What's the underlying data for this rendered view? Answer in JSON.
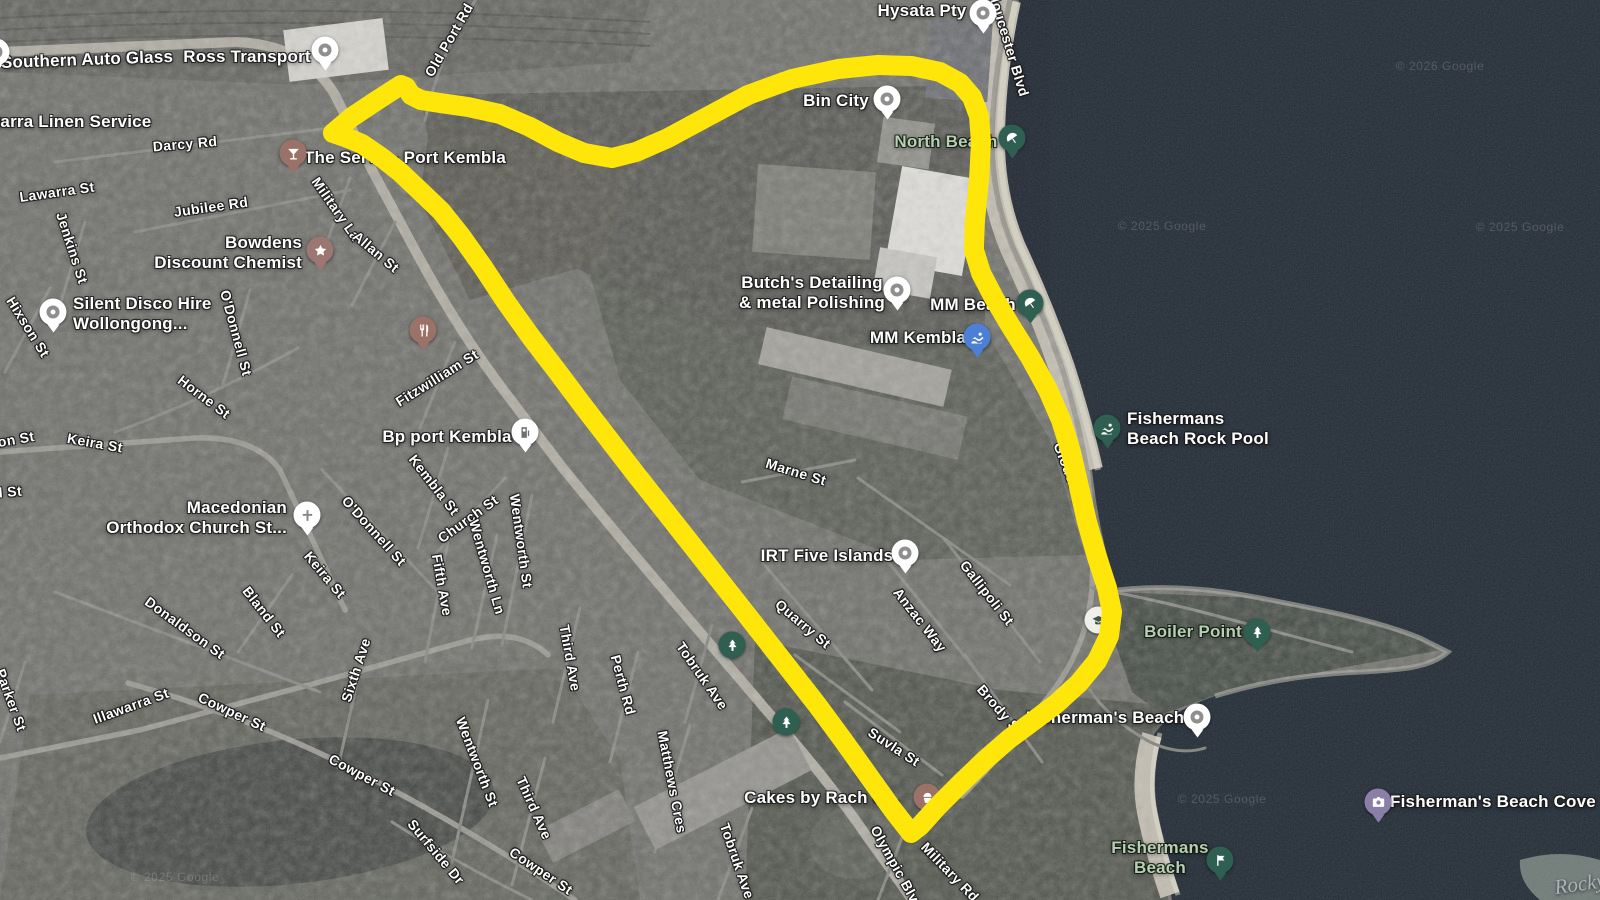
{
  "map": {
    "type": "satellite",
    "region": "Port Kembla",
    "colors": {
      "highlight": "#ffe60a",
      "water": "#1e2631",
      "land": "#696964",
      "sand": "#c2bdb0",
      "street_label": "#ffffff",
      "nature_label": "#b9cfb5"
    }
  },
  "overlay": {
    "name": "suburb-boundary-highlight",
    "color": "#ffe60a",
    "stroke_width": 20,
    "polygon_points": [
      [
        333,
        133
      ],
      [
        352,
        117
      ],
      [
        376,
        101
      ],
      [
        393,
        90
      ],
      [
        401,
        85
      ],
      [
        406,
        87
      ],
      [
        411,
        95
      ],
      [
        421,
        100
      ],
      [
        440,
        103
      ],
      [
        468,
        107
      ],
      [
        500,
        114
      ],
      [
        530,
        127
      ],
      [
        558,
        142
      ],
      [
        584,
        153
      ],
      [
        612,
        158
      ],
      [
        636,
        152
      ],
      [
        668,
        138
      ],
      [
        705,
        118
      ],
      [
        748,
        95
      ],
      [
        792,
        79
      ],
      [
        838,
        69
      ],
      [
        878,
        65
      ],
      [
        912,
        66
      ],
      [
        940,
        72
      ],
      [
        960,
        83
      ],
      [
        972,
        97
      ],
      [
        979,
        116
      ],
      [
        981,
        142
      ],
      [
        979,
        180
      ],
      [
        975,
        220
      ],
      [
        974,
        250
      ],
      [
        981,
        273
      ],
      [
        994,
        298
      ],
      [
        1010,
        325
      ],
      [
        1030,
        357
      ],
      [
        1048,
        390
      ],
      [
        1061,
        420
      ],
      [
        1071,
        452
      ],
      [
        1079,
        487
      ],
      [
        1087,
        522
      ],
      [
        1097,
        557
      ],
      [
        1107,
        588
      ],
      [
        1112,
        612
      ],
      [
        1109,
        636
      ],
      [
        1097,
        661
      ],
      [
        1079,
        683
      ],
      [
        1056,
        704
      ],
      [
        1032,
        722
      ],
      [
        1009,
        739
      ],
      [
        986,
        759
      ],
      [
        962,
        782
      ],
      [
        938,
        806
      ],
      [
        920,
        826
      ],
      [
        911,
        833
      ],
      [
        893,
        810
      ],
      [
        868,
        775
      ],
      [
        843,
        740
      ],
      [
        818,
        706
      ],
      [
        793,
        674
      ],
      [
        768,
        642
      ],
      [
        743,
        610
      ],
      [
        717,
        577
      ],
      [
        691,
        544
      ],
      [
        665,
        511
      ],
      [
        638,
        477
      ],
      [
        611,
        442
      ],
      [
        584,
        407
      ],
      [
        557,
        371
      ],
      [
        531,
        337
      ],
      [
        506,
        302
      ],
      [
        483,
        267
      ],
      [
        461,
        236
      ],
      [
        441,
        211
      ],
      [
        419,
        190
      ],
      [
        400,
        172
      ],
      [
        381,
        157
      ],
      [
        362,
        144
      ],
      [
        345,
        137
      ],
      [
        333,
        133
      ]
    ]
  },
  "labels": [
    {
      "text": "Southern Auto Glass",
      "x": 87,
      "y": 60,
      "rot": -2,
      "cls": "poi"
    },
    {
      "text": "Ross Transport",
      "x": 247,
      "y": 57,
      "rot": 0,
      "cls": "poi"
    },
    {
      "text": "Illawarra Linen Service",
      "x": 57,
      "y": 122,
      "rot": 0,
      "cls": "poi"
    },
    {
      "text": "Darcy Rd",
      "x": 185,
      "y": 144,
      "rot": -5,
      "cls": "st"
    },
    {
      "text": "Lawarra St",
      "x": 57,
      "y": 192,
      "rot": -8,
      "cls": "st"
    },
    {
      "text": "Jubilee Rd",
      "x": 211,
      "y": 207,
      "rot": -8,
      "cls": "st"
    },
    {
      "text": "Jenkins St",
      "x": 72,
      "y": 248,
      "rot": 72,
      "cls": "st"
    },
    {
      "text": "Hixson St",
      "x": 28,
      "y": 327,
      "rot": 58,
      "cls": "st"
    },
    {
      "text": "Bowdens\nDiscount Chemist",
      "x": 302,
      "y": 253,
      "rot": 0,
      "cls": "poi",
      "align": "right"
    },
    {
      "text": "Silent Disco Hire\nWollongong...",
      "x": 73,
      "y": 314,
      "rot": 0,
      "cls": "poi",
      "align": "left"
    },
    {
      "text": "Military La",
      "x": 336,
      "y": 209,
      "rot": 55,
      "cls": "st"
    },
    {
      "text": "Allan St",
      "x": 376,
      "y": 252,
      "rot": 40,
      "cls": "st"
    },
    {
      "text": "The Servo - Port Kembla",
      "x": 405,
      "y": 158,
      "rot": 0,
      "cls": "poi"
    },
    {
      "text": "Old Port Rd",
      "x": 449,
      "y": 40,
      "rot": -60,
      "cls": "st"
    },
    {
      "text": "Hysata Pty",
      "x": 922,
      "y": 11,
      "rot": 0,
      "cls": "poi"
    },
    {
      "text": "Bin City",
      "x": 836,
      "y": 101,
      "rot": 0,
      "cls": "poi"
    },
    {
      "text": "North Beach",
      "x": 946,
      "y": 142,
      "rot": 0,
      "cls": "nature"
    },
    {
      "text": "Gloucester Blvd",
      "x": 1008,
      "y": 42,
      "rot": 73,
      "cls": "st"
    },
    {
      "text": "Butch's Detailing\n& metal Polishing",
      "x": 812,
      "y": 293,
      "rot": 0,
      "cls": "poi"
    },
    {
      "text": "MM Beach",
      "x": 973,
      "y": 305,
      "rot": 0,
      "cls": "poi"
    },
    {
      "text": "MM Kembla",
      "x": 918,
      "y": 338,
      "rot": 0,
      "cls": "poi"
    },
    {
      "text": "Fishermans\nBeach Rock Pool",
      "x": 1127,
      "y": 429,
      "rot": 0,
      "cls": "poi",
      "align": "left"
    },
    {
      "text": "Bp port Kembla",
      "x": 447,
      "y": 437,
      "rot": 0,
      "cls": "poi"
    },
    {
      "text": "Fitzwilliam St",
      "x": 437,
      "y": 378,
      "rot": -32,
      "cls": "st"
    },
    {
      "text": "O'Donnell St",
      "x": 236,
      "y": 333,
      "rot": 75,
      "cls": "st"
    },
    {
      "text": "O'Donnell St",
      "x": 374,
      "y": 531,
      "rot": 48,
      "cls": "st"
    },
    {
      "text": "Horne St",
      "x": 204,
      "y": 397,
      "rot": 37,
      "cls": "st"
    },
    {
      "text": "Keira St",
      "x": 95,
      "y": 443,
      "rot": 10,
      "cls": "st"
    },
    {
      "text": "son St",
      "x": 12,
      "y": 440,
      "rot": -10,
      "cls": "st"
    },
    {
      "text": "d St",
      "x": 8,
      "y": 492,
      "rot": -5,
      "cls": "st"
    },
    {
      "text": "Macedonian\nOrthodox Church St...",
      "x": 287,
      "y": 518,
      "rot": 0,
      "cls": "poi",
      "align": "right"
    },
    {
      "text": "Kembla St",
      "x": 434,
      "y": 485,
      "rot": 52,
      "cls": "st"
    },
    {
      "text": "Church St",
      "x": 468,
      "y": 519,
      "rot": -36,
      "cls": "st"
    },
    {
      "text": "Keira St",
      "x": 325,
      "y": 575,
      "rot": 50,
      "cls": "st"
    },
    {
      "text": "Bland St",
      "x": 264,
      "y": 612,
      "rot": 52,
      "cls": "st"
    },
    {
      "text": "Donaldson St",
      "x": 185,
      "y": 628,
      "rot": 36,
      "cls": "st"
    },
    {
      "text": "Parker St",
      "x": 11,
      "y": 700,
      "rot": 70,
      "cls": "st"
    },
    {
      "text": "Illawarra St",
      "x": 131,
      "y": 706,
      "rot": -20,
      "cls": "st"
    },
    {
      "text": "Cowper St",
      "x": 232,
      "y": 712,
      "rot": 25,
      "cls": "st"
    },
    {
      "text": "Sixth Ave",
      "x": 356,
      "y": 670,
      "rot": -72,
      "cls": "st"
    },
    {
      "text": "Cowper St",
      "x": 362,
      "y": 775,
      "rot": 28,
      "cls": "st"
    },
    {
      "text": "Fifth Ave",
      "x": 442,
      "y": 585,
      "rot": 80,
      "cls": "st"
    },
    {
      "text": "Wentworth Ln",
      "x": 487,
      "y": 567,
      "rot": 74,
      "cls": "st"
    },
    {
      "text": "Wentworth St",
      "x": 521,
      "y": 541,
      "rot": 82,
      "cls": "st"
    },
    {
      "text": "Wentworth St",
      "x": 477,
      "y": 762,
      "rot": 69,
      "cls": "st"
    },
    {
      "text": "Third Ave",
      "x": 570,
      "y": 658,
      "rot": 80,
      "cls": "st"
    },
    {
      "text": "Third Ave",
      "x": 534,
      "y": 808,
      "rot": 66,
      "cls": "st"
    },
    {
      "text": "Perth Rd",
      "x": 623,
      "y": 685,
      "rot": 75,
      "cls": "st"
    },
    {
      "text": "Tobruk Ave",
      "x": 702,
      "y": 676,
      "rot": 55,
      "cls": "st"
    },
    {
      "text": "Tobruk Ave",
      "x": 737,
      "y": 861,
      "rot": 71,
      "cls": "st"
    },
    {
      "text": "Matthews Cres",
      "x": 672,
      "y": 782,
      "rot": 79,
      "cls": "st"
    },
    {
      "text": "Surfside Dr",
      "x": 436,
      "y": 852,
      "rot": 50,
      "cls": "st"
    },
    {
      "text": "Cowper St",
      "x": 541,
      "y": 871,
      "rot": 34,
      "cls": "st"
    },
    {
      "text": "Marne St",
      "x": 796,
      "y": 472,
      "rot": 17,
      "cls": "st"
    },
    {
      "text": "IRT Five Islands",
      "x": 827,
      "y": 556,
      "rot": 0,
      "cls": "poi"
    },
    {
      "text": "Gallipoli St",
      "x": 987,
      "y": 593,
      "rot": 52,
      "cls": "st"
    },
    {
      "text": "Anzac Way",
      "x": 920,
      "y": 620,
      "rot": 52,
      "cls": "st"
    },
    {
      "text": "Quarry St",
      "x": 803,
      "y": 624,
      "rot": 40,
      "cls": "st"
    },
    {
      "text": "Gloucester Blvd",
      "x": 1078,
      "y": 496,
      "rot": 69,
      "cls": "st"
    },
    {
      "text": "Suvla St",
      "x": 894,
      "y": 747,
      "rot": 33,
      "cls": "st"
    },
    {
      "text": "Brody St",
      "x": 1000,
      "y": 710,
      "rot": 49,
      "cls": "st"
    },
    {
      "text": "Boiler Point",
      "x": 1193,
      "y": 632,
      "rot": 0,
      "cls": "nature"
    },
    {
      "text": "Fisherman's Beach",
      "x": 1105,
      "y": 718,
      "rot": 0,
      "cls": "poi"
    },
    {
      "text": "Cakes by Rach C...",
      "x": 822,
      "y": 798,
      "rot": 0,
      "cls": "poi"
    },
    {
      "text": "Olympic Blvd",
      "x": 897,
      "y": 868,
      "rot": 61,
      "cls": "st"
    },
    {
      "text": "Military Rd",
      "x": 950,
      "y": 872,
      "rot": 46,
      "cls": "st"
    },
    {
      "text": "Fishermans\nBeach",
      "x": 1160,
      "y": 858,
      "rot": 0,
      "cls": "nature"
    },
    {
      "text": "Fisherman's Beach Cove",
      "x": 1493,
      "y": 802,
      "rot": 0,
      "cls": "poi"
    },
    {
      "text": "Rocky",
      "x": 1580,
      "y": 884,
      "rot": -8,
      "cls": "terrain-lbl"
    },
    {
      "text": "© 2026 Google",
      "x": 1440,
      "y": 66,
      "rot": 0,
      "cls": "wm"
    },
    {
      "text": "© 2025 Google",
      "x": 1162,
      "y": 226,
      "rot": 0,
      "cls": "wm"
    },
    {
      "text": "© 2025 Google",
      "x": 1520,
      "y": 227,
      "rot": 0,
      "cls": "wm"
    },
    {
      "text": "© 2025 Google",
      "x": 1222,
      "y": 799,
      "rot": 0,
      "cls": "wm"
    },
    {
      "text": "© 2025 Google",
      "x": 175,
      "y": 877,
      "rot": 0,
      "cls": "wm"
    }
  ],
  "markers": [
    {
      "name": "southern-auto-glass",
      "x": -4,
      "y": 52,
      "bg": "#ffffff",
      "glyph": "dot",
      "tail": true
    },
    {
      "name": "ross-transport",
      "x": 325,
      "y": 50,
      "bg": "#ffffff",
      "glyph": "dot",
      "tail": true
    },
    {
      "name": "the-servo-bar",
      "x": 293,
      "y": 153,
      "bg": "#9b7268",
      "glyph": "martini",
      "fg": "#ffffff",
      "tail": true
    },
    {
      "name": "bowdens-chemist",
      "x": 320,
      "y": 250,
      "bg": "#9c7672",
      "glyph": "star",
      "fg": "#ffffff",
      "tail": true
    },
    {
      "name": "silent-disco-hire",
      "x": 53,
      "y": 312,
      "bg": "#ffffff",
      "glyph": "dot",
      "tail": true
    },
    {
      "name": "the-iron-yampi",
      "x": 423,
      "y": 330,
      "bg": "#9b7268",
      "glyph": "restaurant",
      "fg": "#ffffff",
      "tail": true
    },
    {
      "name": "macedonian-church",
      "x": 307,
      "y": 515,
      "bg": "#ffffff",
      "glyph": "cross",
      "fg": "#8a8a8a",
      "tail": true
    },
    {
      "name": "bp-port-kembla",
      "x": 525,
      "y": 432,
      "bg": "#ffffff",
      "glyph": "fuel",
      "fg": "#6f6f6f",
      "tail": true
    },
    {
      "name": "hysata-pty",
      "x": 983,
      "y": 13,
      "bg": "#ffffff",
      "glyph": "dot",
      "tail": true
    },
    {
      "name": "bin-city",
      "x": 887,
      "y": 99,
      "bg": "#ffffff",
      "glyph": "dot",
      "tail": true
    },
    {
      "name": "butchs-detailing",
      "x": 897,
      "y": 290,
      "bg": "#ffffff",
      "glyph": "dot",
      "tail": true
    },
    {
      "name": "north-beach",
      "x": 1012,
      "y": 138,
      "bg": "#2f5f51",
      "glyph": "umbrella",
      "fg": "#ffffff",
      "tail": true
    },
    {
      "name": "mm-beach",
      "x": 1030,
      "y": 303,
      "bg": "#2f5f51",
      "glyph": "umbrella",
      "fg": "#ffffff",
      "tail": true
    },
    {
      "name": "mm-kembla",
      "x": 977,
      "y": 337,
      "bg": "#4d7fd6",
      "glyph": "swim",
      "fg": "#ffffff",
      "tail": true
    },
    {
      "name": "irt-five-islands",
      "x": 905,
      "y": 553,
      "bg": "#ffffff",
      "glyph": "dot",
      "tail": true
    },
    {
      "name": "fishermans-beach-rock-pool",
      "x": 1107,
      "y": 428,
      "bg": "#2f5f51",
      "glyph": "swim",
      "fg": "#ffffff",
      "tail": true
    },
    {
      "name": "park-tree-a",
      "x": 732,
      "y": 645,
      "bg": "#2f5f51",
      "glyph": "tree",
      "fg": "#ffffff",
      "tail": false
    },
    {
      "name": "park-tree-b",
      "x": 786,
      "y": 722,
      "bg": "#2f5f51",
      "glyph": "tree",
      "fg": "#ffffff",
      "tail": false
    },
    {
      "name": "school",
      "x": 1098,
      "y": 620,
      "bg": "#efeee9",
      "glyph": "grad",
      "fg": "#44544b",
      "tail": false
    },
    {
      "name": "boiler-point-park",
      "x": 1257,
      "y": 632,
      "bg": "#2f5f51",
      "glyph": "tree",
      "fg": "#ffffff",
      "tail": true
    },
    {
      "name": "fishermans-beach-poi",
      "x": 1197,
      "y": 717,
      "bg": "#ffffff",
      "glyph": "dot",
      "tail": true
    },
    {
      "name": "fishermans-beach-flag",
      "x": 1220,
      "y": 860,
      "bg": "#2f5f51",
      "glyph": "flag",
      "fg": "#ffffff",
      "tail": true
    },
    {
      "name": "fishermans-beach-cove-photo",
      "x": 1378,
      "y": 802,
      "bg": "#8b7fa8",
      "glyph": "camera",
      "fg": "#ffffff",
      "tail": true
    },
    {
      "name": "cakes-by-rach",
      "x": 927,
      "y": 797,
      "bg": "#9b7268",
      "glyph": "cupcake",
      "fg": "#ffffff",
      "tail": true
    }
  ]
}
